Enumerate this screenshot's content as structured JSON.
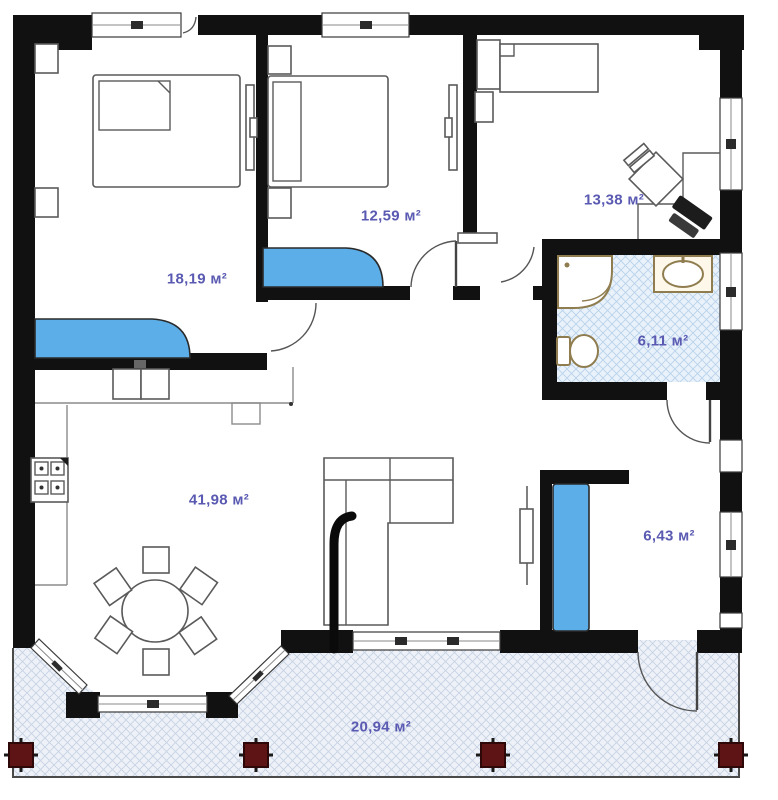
{
  "plan": {
    "room_areas": {
      "bedroom_left": "18,19 м²",
      "bedroom_middle": "12,59 м²",
      "office_top_right": "13,38 м²",
      "bathroom": "6,11 м²",
      "living_kitchen": "41,98 м²",
      "entry_room": "6,43 м²",
      "terrace": "20,94 м²"
    }
  },
  "colors": {
    "wall_black": "#111111",
    "wardrobe_blue": "#5caee8",
    "label_blue": "#5a5ab2",
    "column_red": "#5e1414",
    "fixture_tan": "#8f7d4f",
    "bath_floor": "#e9f2fb",
    "bath_hatch": "#b9d2ea",
    "terrace_floor": "#eef2f8",
    "terrace_hatch": "#c7d2e3"
  }
}
